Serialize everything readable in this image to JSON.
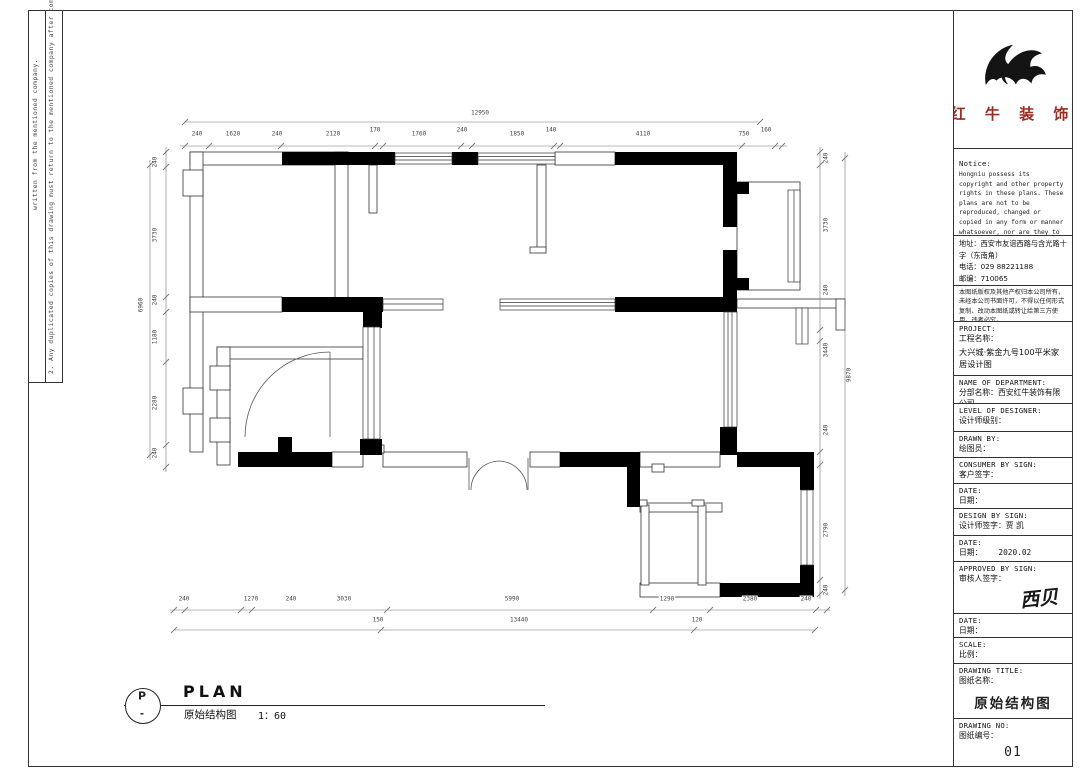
{
  "margin_notes": {
    "note1": "written from the mentioned company.",
    "note2": "2. Any duplicated copies of this drawing must return to the mentioned company after completion of work."
  },
  "logo": {
    "company": "红 牛 装 饰",
    "accent_color": "#9e2b22"
  },
  "title_block": {
    "notice": {
      "label": "Notice:",
      "body": "Hongniu possess its copyright and other property rights in these plans. These plans are not to be reproduced, changed or copied in any form or manner whatsoever, nor are they to be assigned to any third party without first obtaining the expressed written permission and consent."
    },
    "contact": {
      "line1": "地址：西安市友谊西路与含光路十字（东南角）",
      "line2": "电话：029 88221188",
      "line3": "邮编：710065"
    },
    "statement": "本图纸版权及其他产权归本公司所有，未经本公司书面许可，不得以任何形式复制、改动本图纸或转让给第三方使用，违者必究。",
    "fields": {
      "project": {
        "en": "PROJECT:",
        "cn": "工程名称：",
        "value": "大兴城·紫金九号100平米家居设计图"
      },
      "department": {
        "en": "NAME OF DEPARTMENT:",
        "cn": "分部名称：",
        "value": "西安红牛装饰有限公司"
      },
      "level": {
        "en": "LEVEL OF DESIGNER:",
        "cn": "设计师级别："
      },
      "drawn": {
        "en": "DRAWN BY:",
        "cn": "绘图员："
      },
      "consumer": {
        "en": "CONSUMER BY SIGN:",
        "cn": "客户签字："
      },
      "date1": {
        "en": "DATE:",
        "cn": "日期："
      },
      "design": {
        "en": "DESIGN BY SIGN:",
        "cn": "设计师签字：",
        "value": "贾 凯"
      },
      "date2": {
        "en": "DATE:",
        "cn": "日期：",
        "value": "2020.02"
      },
      "approved": {
        "en": "APPROVED BY SIGN:",
        "cn": "审核人签字：",
        "signature": "西贝"
      },
      "date3": {
        "en": "DATE:",
        "cn": "日期："
      },
      "scale": {
        "en": "SCALE:",
        "cn": "比例："
      },
      "drawing_title": {
        "en": "DRAWING TITLE:",
        "cn": "图纸名称：",
        "value": "原始结构图"
      },
      "drawing_no": {
        "en": "DRAWING NO:",
        "cn": "图纸编号：",
        "value": "01"
      }
    }
  },
  "plan_callout": {
    "bubble_top": "P",
    "bubble_bottom": "-",
    "title": "PLAN",
    "subtitle": "原始结构图",
    "scale": "1：60"
  },
  "dimensions": {
    "horizontal": [
      {
        "t": "12950",
        "x": 480,
        "y": 113
      },
      {
        "t": "240",
        "x": 197,
        "y": 134
      },
      {
        "t": "1620",
        "x": 233,
        "y": 134
      },
      {
        "t": "240",
        "x": 277,
        "y": 134
      },
      {
        "t": "2120",
        "x": 333,
        "y": 134
      },
      {
        "t": "170",
        "x": 375,
        "y": 130
      },
      {
        "t": "1760",
        "x": 419,
        "y": 134
      },
      {
        "t": "240",
        "x": 462,
        "y": 130
      },
      {
        "t": "1850",
        "x": 517,
        "y": 134
      },
      {
        "t": "140",
        "x": 551,
        "y": 130
      },
      {
        "t": "4110",
        "x": 643,
        "y": 134
      },
      {
        "t": "750",
        "x": 744,
        "y": 134
      },
      {
        "t": "160",
        "x": 766,
        "y": 130
      },
      {
        "t": "240",
        "x": 184,
        "y": 599
      },
      {
        "t": "1270",
        "x": 251,
        "y": 599
      },
      {
        "t": "240",
        "x": 291,
        "y": 599
      },
      {
        "t": "3030",
        "x": 344,
        "y": 599
      },
      {
        "t": "5990",
        "x": 512,
        "y": 599
      },
      {
        "t": "1290",
        "x": 667,
        "y": 599
      },
      {
        "t": "2380",
        "x": 750,
        "y": 599
      },
      {
        "t": "240",
        "x": 806,
        "y": 599
      },
      {
        "t": "150",
        "x": 378,
        "y": 620
      },
      {
        "t": "13440",
        "x": 519,
        "y": 620
      },
      {
        "t": "120",
        "x": 697,
        "y": 620
      }
    ],
    "vertical": [
      {
        "t": "240",
        "x": 155,
        "y": 162
      },
      {
        "t": "3730",
        "x": 155,
        "y": 235
      },
      {
        "t": "240",
        "x": 155,
        "y": 300
      },
      {
        "t": "1180",
        "x": 155,
        "y": 337
      },
      {
        "t": "2280",
        "x": 155,
        "y": 403
      },
      {
        "t": "240",
        "x": 155,
        "y": 453
      },
      {
        "t": "6960",
        "x": 141,
        "y": 305
      },
      {
        "t": "240",
        "x": 826,
        "y": 158
      },
      {
        "t": "3730",
        "x": 826,
        "y": 225
      },
      {
        "t": "240",
        "x": 826,
        "y": 290
      },
      {
        "t": "3440",
        "x": 826,
        "y": 350
      },
      {
        "t": "240",
        "x": 826,
        "y": 430
      },
      {
        "t": "2790",
        "x": 826,
        "y": 530
      },
      {
        "t": "240",
        "x": 826,
        "y": 590
      },
      {
        "t": "9870",
        "x": 849,
        "y": 375
      }
    ]
  }
}
